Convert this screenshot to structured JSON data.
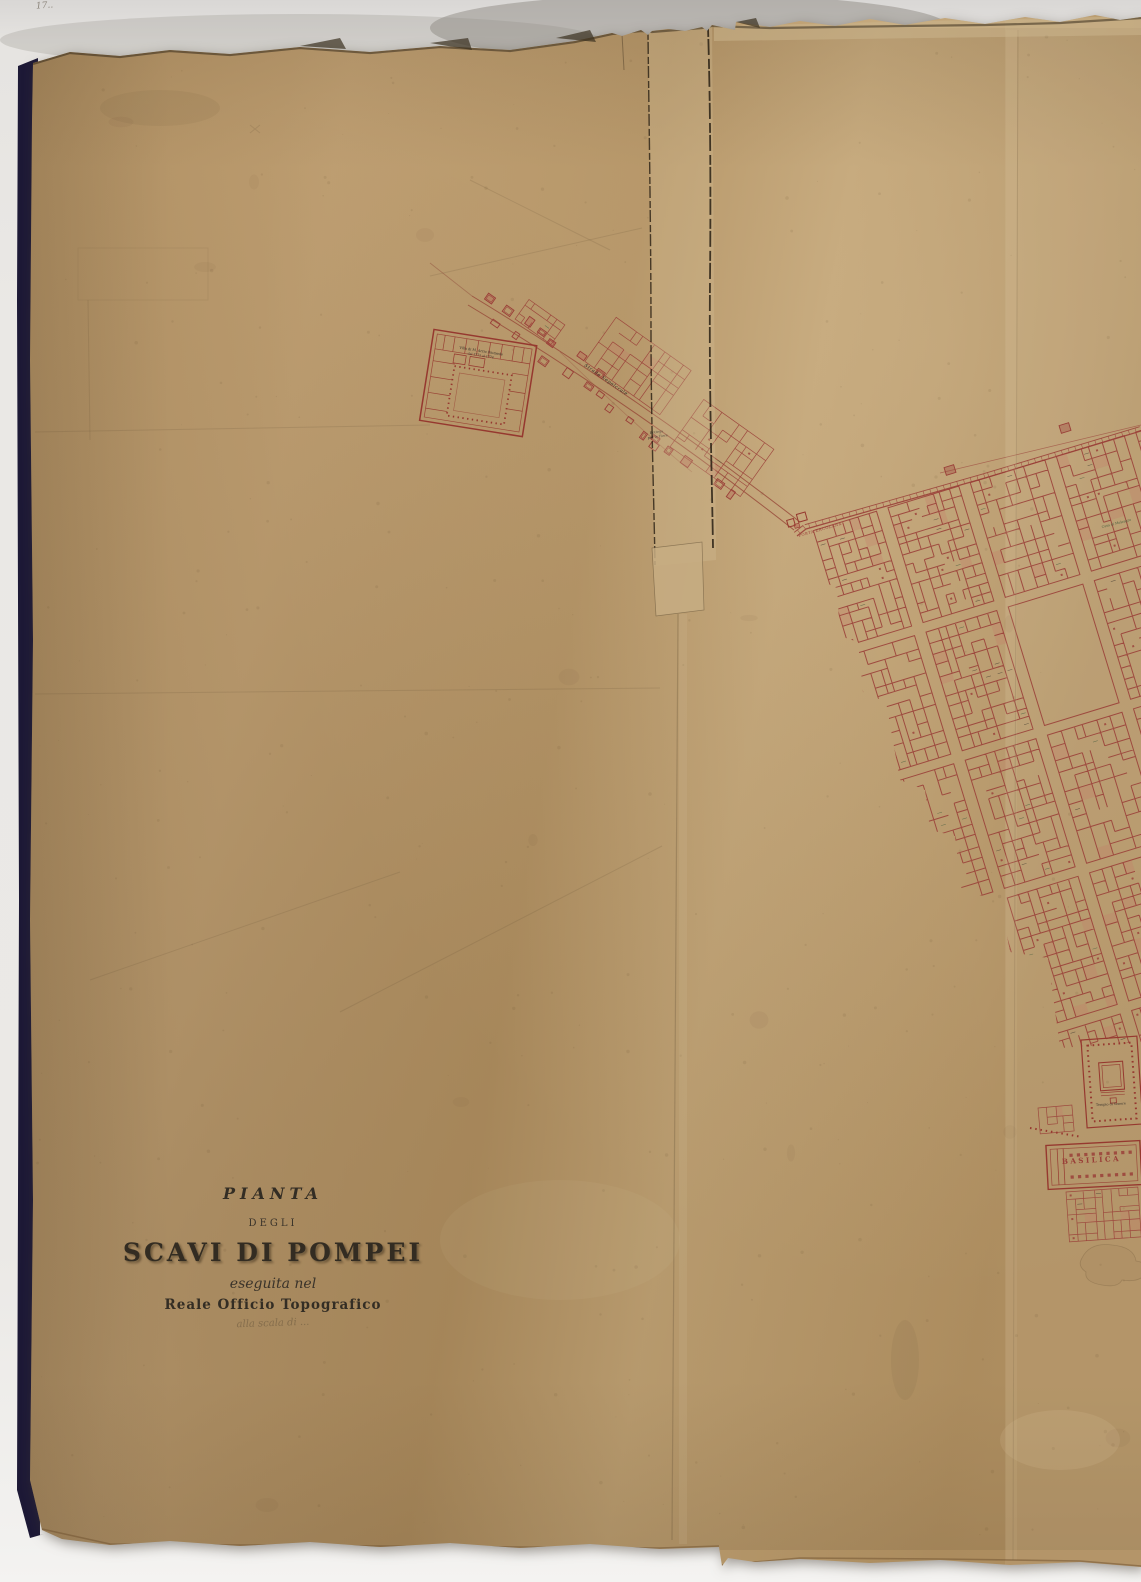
{
  "document_type": "scanned historical map sheet",
  "title_block": {
    "pianta": "PIANTA",
    "degli": "DEGLI",
    "main_title": "SCAVI DI POMPEI",
    "eseguita": "eseguita nel",
    "office": "Reale Officio Topografico",
    "scale_note": "alla scala di ..."
  },
  "map_labels": {
    "villa_name": "Villa di M. Arrio Diomede",
    "villa_date": "dal 1771 al 1774",
    "street": "Strada Sepolcrale",
    "bottega_line1": "Bottega",
    "bottega_line2": "per le Fiere",
    "gate": "PORTA ERCOLANA",
    "casa_meleagro": "Casa di Meleagro",
    "tempio_venere": "Tempio di Venere",
    "basilica": "BASILICA",
    "corner_note": "17.."
  },
  "colors": {
    "background": "#eae8e5",
    "paper": "#b6976a",
    "ink_red": "#9a3f38",
    "ink_dark": "#35302a",
    "ink_green": "#4a6040",
    "board_edge": "#1d1936",
    "pencil": "#5c4c36"
  }
}
